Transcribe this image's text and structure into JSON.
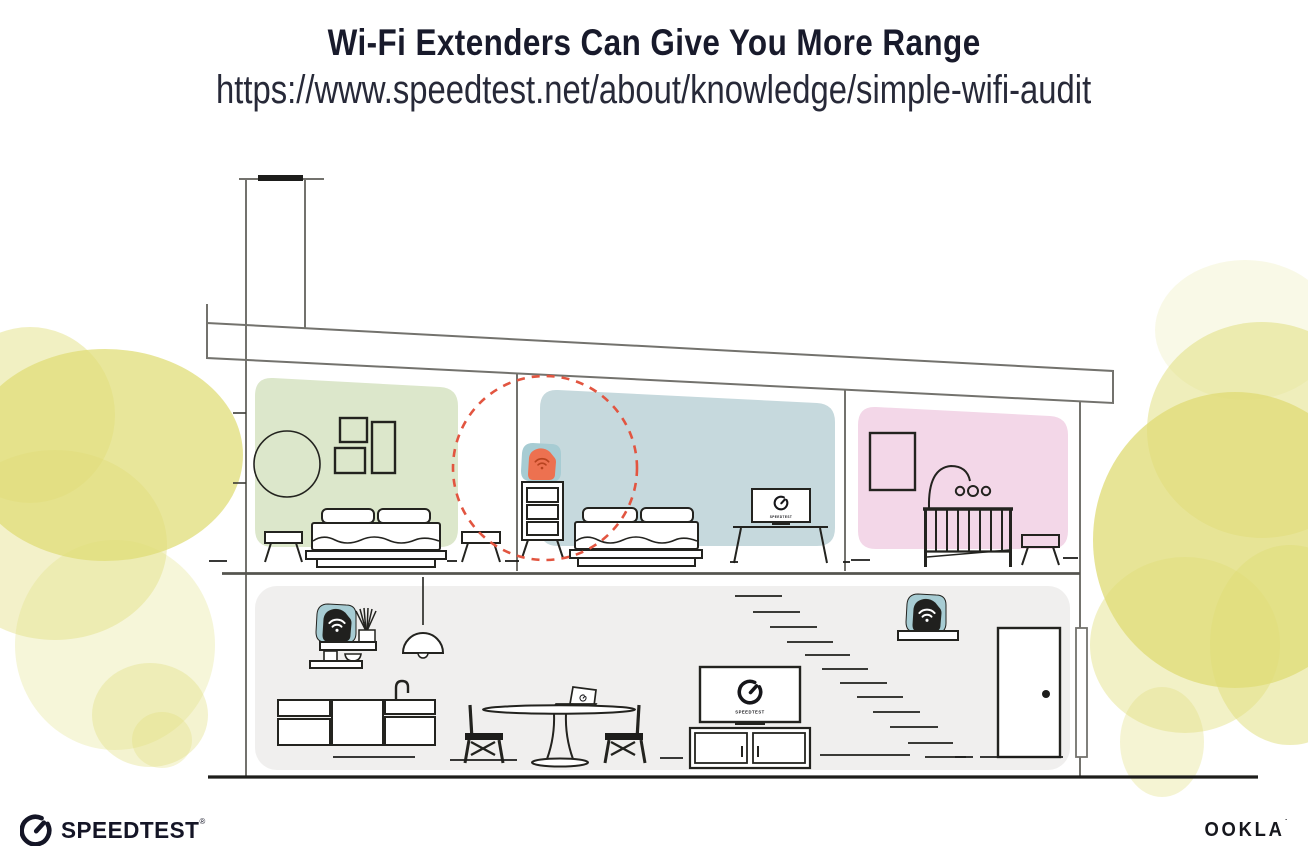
{
  "header": {
    "title": "Wi-Fi Extenders Can Give You More Range",
    "url": "https://www.speedtest.net/about/knowledge/simple-wifi-audit"
  },
  "illustration": {
    "tv_label": "SPEEDTEST",
    "devices": [
      {
        "id": "wifi-extender-upstairs-dresser",
        "highlight": "orange",
        "range_circle": true
      },
      {
        "id": "wifi-router-wall-shelf"
      },
      {
        "id": "wifi-extender-stairs-shelf"
      }
    ],
    "icons": {
      "wifi": "wifi-icon",
      "gauge": "speedtest-gauge-icon"
    },
    "colors": {
      "bedroom_green": "#dce7cb",
      "bedroom_blue": "#c6d9dd",
      "nursery_pink": "#f3d7e8",
      "lower_floor_gray": "#f0efee",
      "extender_orange": "#ed7150",
      "extender_wifi_dark": "#b8431f",
      "device_black": "#20201e",
      "device_teal_halo": "#a7ccd3",
      "range_circle_red": "#e25540",
      "foliage_yellow": "#e0dd78",
      "outline_gray": "#73726d",
      "ink_black": "#1d1d1b"
    }
  },
  "footer": {
    "speedtest": {
      "label": "SPEEDTEST",
      "reg": "®"
    },
    "ookla": {
      "label": "OOKLA",
      "reg": "˙"
    }
  }
}
